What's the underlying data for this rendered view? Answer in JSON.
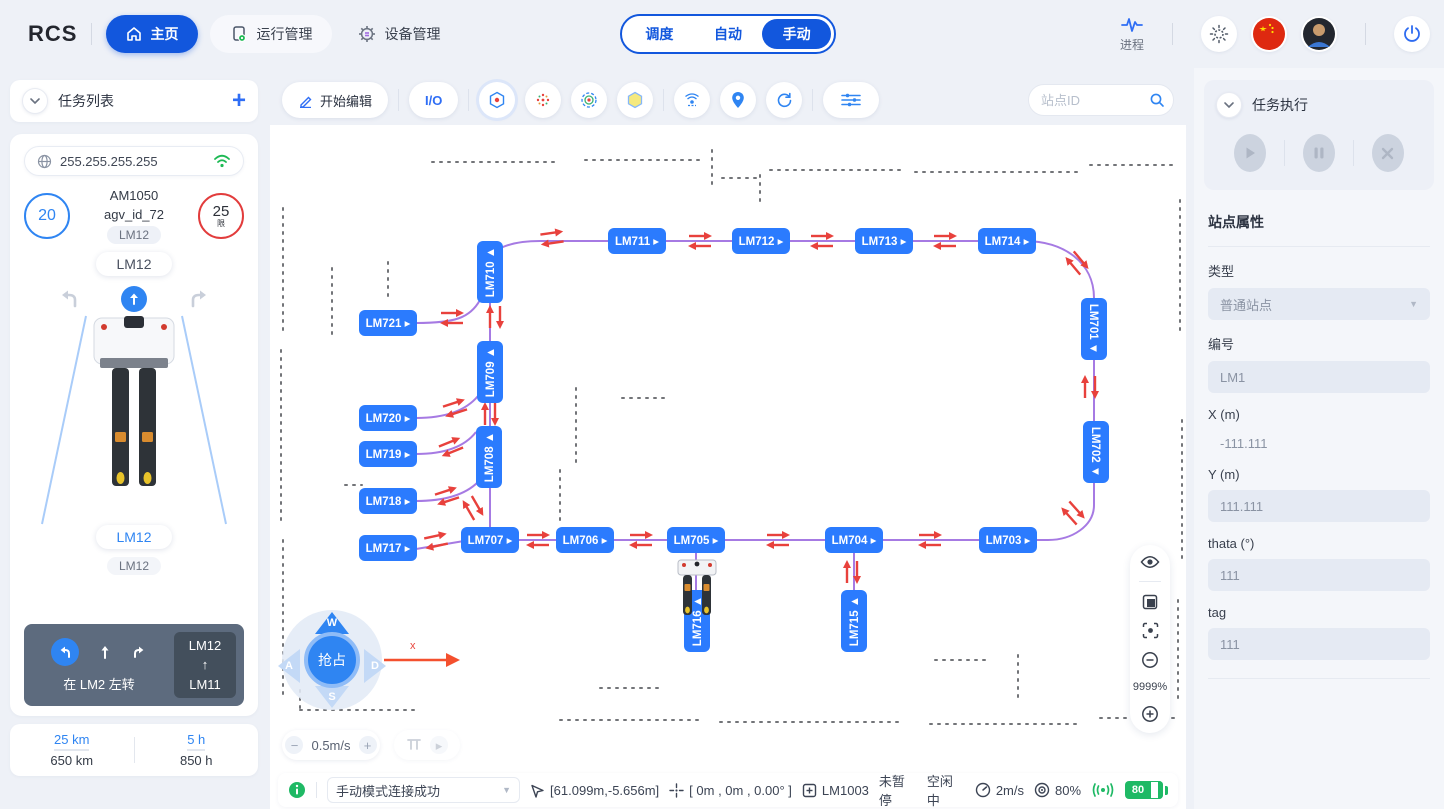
{
  "navbar": {
    "logo": "RCS",
    "nav": [
      {
        "label": "主页"
      },
      {
        "label": "运行管理"
      },
      {
        "label": "设备管理"
      }
    ],
    "modes": [
      "调度",
      "自动",
      "手动"
    ],
    "active_mode": "手动",
    "process_label": "进程"
  },
  "left": {
    "header": "任务列表",
    "ip": "255.255.255.255",
    "speed": "20",
    "limit": "25",
    "limit_suffix": "限",
    "model": "AM1050",
    "agv_id": "agv_id_72",
    "tag_a": "LM12",
    "tag_b": "LM12",
    "tag_c": "LM12",
    "tag_d": "LM12",
    "turn_text": "在 LM2 左转",
    "route_from": "LM12",
    "route_to": "LM11",
    "stats": {
      "dist_today": "25 km",
      "dist_total": "650 km",
      "time_today": "5 h",
      "time_total": "850 h"
    }
  },
  "toolbar": {
    "edit_label": "开始编辑",
    "io_label": "I/O",
    "search_placeholder": "站点ID"
  },
  "map": {
    "zoom_percent": "9999%",
    "grab_label": "抢占",
    "speed_value": "0.5m/s",
    "axis_label": "x",
    "joystick": [
      "W",
      "A",
      "S",
      "D"
    ],
    "station_color": "#2b7bfe",
    "path_color": "#9c6ce0",
    "arrow_color": "#e8413c",
    "stations": [
      {
        "id": "LM711",
        "x": 637,
        "y": 241,
        "o": "h"
      },
      {
        "id": "LM712",
        "x": 761,
        "y": 241,
        "o": "h"
      },
      {
        "id": "LM713",
        "x": 884,
        "y": 241,
        "o": "h"
      },
      {
        "id": "LM714",
        "x": 1007,
        "y": 241,
        "o": "h"
      },
      {
        "id": "LM721",
        "x": 388,
        "y": 323,
        "o": "h"
      },
      {
        "id": "LM720",
        "x": 388,
        "y": 418,
        "o": "h"
      },
      {
        "id": "LM719",
        "x": 388,
        "y": 454,
        "o": "h"
      },
      {
        "id": "LM718",
        "x": 388,
        "y": 501,
        "o": "h"
      },
      {
        "id": "LM717",
        "x": 388,
        "y": 548,
        "o": "h"
      },
      {
        "id": "LM707",
        "x": 490,
        "y": 540,
        "o": "h"
      },
      {
        "id": "LM706",
        "x": 585,
        "y": 540,
        "o": "h"
      },
      {
        "id": "LM705",
        "x": 696,
        "y": 540,
        "o": "h"
      },
      {
        "id": "LM704",
        "x": 854,
        "y": 540,
        "o": "h"
      },
      {
        "id": "LM703",
        "x": 1008,
        "y": 540,
        "o": "h"
      },
      {
        "id": "LM710",
        "x": 490,
        "y": 272,
        "o": "up"
      },
      {
        "id": "LM709",
        "x": 490,
        "y": 372,
        "o": "up"
      },
      {
        "id": "LM708",
        "x": 489,
        "y": 457,
        "o": "up"
      },
      {
        "id": "LM716",
        "x": 697,
        "y": 621,
        "o": "up"
      },
      {
        "id": "LM715",
        "x": 854,
        "y": 621,
        "o": "up"
      },
      {
        "id": "LM701",
        "x": 1094,
        "y": 329,
        "o": "down"
      },
      {
        "id": "LM702",
        "x": 1096,
        "y": 452,
        "o": "down"
      }
    ],
    "arrows": [
      {
        "x": 552,
        "y": 238,
        "r": -8
      },
      {
        "x": 700,
        "y": 241,
        "r": 0
      },
      {
        "x": 822,
        "y": 241,
        "r": 0
      },
      {
        "x": 945,
        "y": 241,
        "r": 0
      },
      {
        "x": 1077,
        "y": 263,
        "r": 50
      },
      {
        "x": 452,
        "y": 318,
        "r": 0
      },
      {
        "x": 495,
        "y": 317,
        "r": 90
      },
      {
        "x": 455,
        "y": 408,
        "r": -18
      },
      {
        "x": 451,
        "y": 447,
        "r": -22
      },
      {
        "x": 490,
        "y": 414,
        "r": 90
      },
      {
        "x": 447,
        "y": 496,
        "r": -18
      },
      {
        "x": 473,
        "y": 508,
        "r": 60
      },
      {
        "x": 436,
        "y": 541,
        "r": -12
      },
      {
        "x": 538,
        "y": 540,
        "r": 0
      },
      {
        "x": 641,
        "y": 540,
        "r": 0
      },
      {
        "x": 778,
        "y": 540,
        "r": 0
      },
      {
        "x": 930,
        "y": 540,
        "r": 0
      },
      {
        "x": 852,
        "y": 572,
        "r": 90
      },
      {
        "x": 1090,
        "y": 387,
        "r": 90
      },
      {
        "x": 1073,
        "y": 513,
        "r": 48
      }
    ]
  },
  "status": {
    "message": "手动模式连接成功",
    "position": "[61.099m,-5.656m]",
    "offset": "[ 0m , 0m , 0.00° ]",
    "station": "LM1003",
    "pause_state": "未暂停",
    "work_state": "空闲中",
    "speed": "2m/s",
    "accuracy": "80%",
    "battery": "80"
  },
  "right": {
    "header": "任务执行",
    "props_title": "站点属性",
    "fields": [
      {
        "label": "类型",
        "value": "普通站点"
      },
      {
        "label": "编号",
        "value": "LM1"
      },
      {
        "label": "X (m)",
        "value": "-111.111"
      },
      {
        "label": "Y (m)",
        "value": "111.111"
      },
      {
        "label": "thata (°)",
        "value": "111"
      },
      {
        "label": "tag",
        "value": "111"
      }
    ]
  }
}
